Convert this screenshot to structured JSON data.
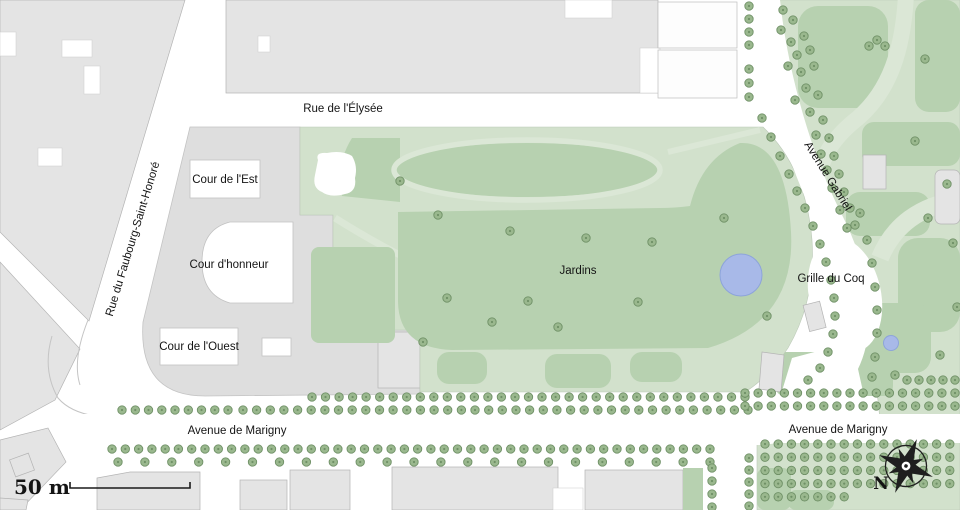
{
  "map": {
    "street_labels": [
      {
        "id": "rue-de-l-elysee",
        "text": "Rue de l'Élysée",
        "x": 343,
        "y": 112,
        "rot": 0
      },
      {
        "id": "rue-du-faubourg-saint-honore",
        "text": "Rue du Faubourg-Saint-Honoré",
        "x": 136,
        "y": 240,
        "rot": -73
      },
      {
        "id": "avenue-gabriel",
        "text": "Avenue Gabriel",
        "x": 825,
        "y": 178,
        "rot": 58
      },
      {
        "id": "avenue-de-marigny-west",
        "text": "Avenue de Marigny",
        "x": 237,
        "y": 434,
        "rot": 0
      },
      {
        "id": "avenue-de-marigny-east",
        "text": "Avenue de Marigny",
        "x": 838,
        "y": 433,
        "rot": 0
      }
    ],
    "place_labels": [
      {
        "id": "cour-de-l-est",
        "text": "Cour de l'Est",
        "x": 225,
        "y": 183
      },
      {
        "id": "cour-d-honneur",
        "text": "Cour d'honneur",
        "x": 229,
        "y": 268
      },
      {
        "id": "cour-de-l-ouest",
        "text": "Cour de l'Ouest",
        "x": 199,
        "y": 350
      },
      {
        "id": "jardins",
        "text": "Jardins",
        "x": 578,
        "y": 274
      },
      {
        "id": "grille-du-coq",
        "text": "Grille du Coq",
        "x": 831,
        "y": 282
      }
    ],
    "scale_bar": {
      "label": "50 m",
      "text_x": 42,
      "text_y": 494,
      "line": {
        "x1": 70,
        "x2": 190,
        "y": 488,
        "tick": 6
      }
    },
    "compass": {
      "label": "N",
      "label_x": 881,
      "label_y": 489,
      "cx": 906,
      "cy": 466,
      "rot": 22
    },
    "ponds": [
      {
        "id": "garden-pond",
        "cx": 741,
        "cy": 275,
        "r": 21
      },
      {
        "id": "small-pond",
        "cx": 891,
        "cy": 343,
        "r": 7.5
      }
    ],
    "colors": {
      "building": "#e4e4e4",
      "building_outline": "#b4b4b4",
      "grounds": "#dedede",
      "park": "#d2e1cc",
      "lawn": "#b7d1b0",
      "path": "#dbe7d6",
      "tree": "#9ab88e",
      "tree_outline": "#6f9066",
      "pond": "#a8b9e8",
      "pond_outline": "#8da4da",
      "road": "#ffffff",
      "text": "#141414"
    },
    "trees": {
      "rows": [
        [
          312,
          397,
          745,
          397,
          33
        ],
        [
          122,
          410,
          228,
          410,
          9
        ],
        [
          243,
          410,
          748,
          410,
          38
        ],
        [
          112,
          449,
          710,
          449,
          46
        ],
        [
          118,
          462,
          710,
          462,
          23
        ],
        [
          749,
          6,
          749,
          45,
          4
        ],
        [
          749,
          69,
          749,
          97,
          3
        ],
        [
          745,
          393,
          955,
          393,
          17
        ],
        [
          745,
          406,
          955,
          406,
          17
        ],
        [
          907,
          380,
          955,
          380,
          5
        ],
        [
          712,
          468,
          712,
          507,
          4
        ],
        [
          749,
          458,
          749,
          506,
          5
        ]
      ],
      "grid": {
        "x0": 765,
        "y0": 444,
        "cols": 15,
        "rows": 5,
        "dx": 13.2,
        "dy": 13.2,
        "skip_x": 856,
        "skip_y": 486
      },
      "points": {
        "gabriel_west": [
          [
            762,
            118
          ],
          [
            771,
            137
          ],
          [
            780,
            156
          ],
          [
            789,
            174
          ],
          [
            797,
            191
          ],
          [
            805,
            208
          ],
          [
            813,
            226
          ],
          [
            820,
            244
          ],
          [
            826,
            262
          ],
          [
            831,
            280
          ],
          [
            834,
            298
          ],
          [
            835,
            316
          ],
          [
            833,
            334
          ],
          [
            828,
            352
          ],
          [
            820,
            368
          ],
          [
            808,
            380
          ]
        ],
        "gabriel_east": [
          [
            783,
            10
          ],
          [
            793,
            20
          ],
          [
            781,
            30
          ],
          [
            791,
            42
          ],
          [
            804,
            36
          ],
          [
            797,
            55
          ],
          [
            810,
            50
          ],
          [
            788,
            66
          ],
          [
            801,
            72
          ],
          [
            814,
            66
          ],
          [
            806,
            88
          ],
          [
            795,
            100
          ],
          [
            818,
            95
          ],
          [
            810,
            112
          ],
          [
            823,
            120
          ],
          [
            816,
            135
          ],
          [
            829,
            138
          ],
          [
            821,
            154
          ],
          [
            834,
            156
          ],
          [
            827,
            170
          ],
          [
            839,
            174
          ],
          [
            832,
            188
          ],
          [
            844,
            192
          ],
          [
            850,
            208
          ],
          [
            840,
            210
          ],
          [
            855,
            225
          ],
          [
            847,
            228
          ],
          [
            860,
            213
          ],
          [
            867,
            240
          ],
          [
            872,
            263
          ],
          [
            875,
            287
          ],
          [
            877,
            310
          ],
          [
            877,
            333
          ],
          [
            875,
            357
          ],
          [
            872,
            377
          ]
        ],
        "right_park": [
          [
            877,
            40
          ],
          [
            869,
            46
          ],
          [
            885,
            46
          ],
          [
            925,
            59
          ],
          [
            915,
            141
          ],
          [
            947,
            184
          ],
          [
            928,
            218
          ],
          [
            953,
            243
          ],
          [
            957,
            307
          ],
          [
            940,
            355
          ],
          [
            895,
            375
          ]
        ],
        "garden": [
          [
            400,
            181
          ],
          [
            438,
            215
          ],
          [
            510,
            231
          ],
          [
            586,
            238
          ],
          [
            652,
            242
          ],
          [
            724,
            218
          ],
          [
            492,
            322
          ],
          [
            528,
            301
          ],
          [
            558,
            327
          ],
          [
            638,
            302
          ],
          [
            767,
            316
          ],
          [
            423,
            342
          ],
          [
            447,
            298
          ]
        ]
      }
    }
  }
}
